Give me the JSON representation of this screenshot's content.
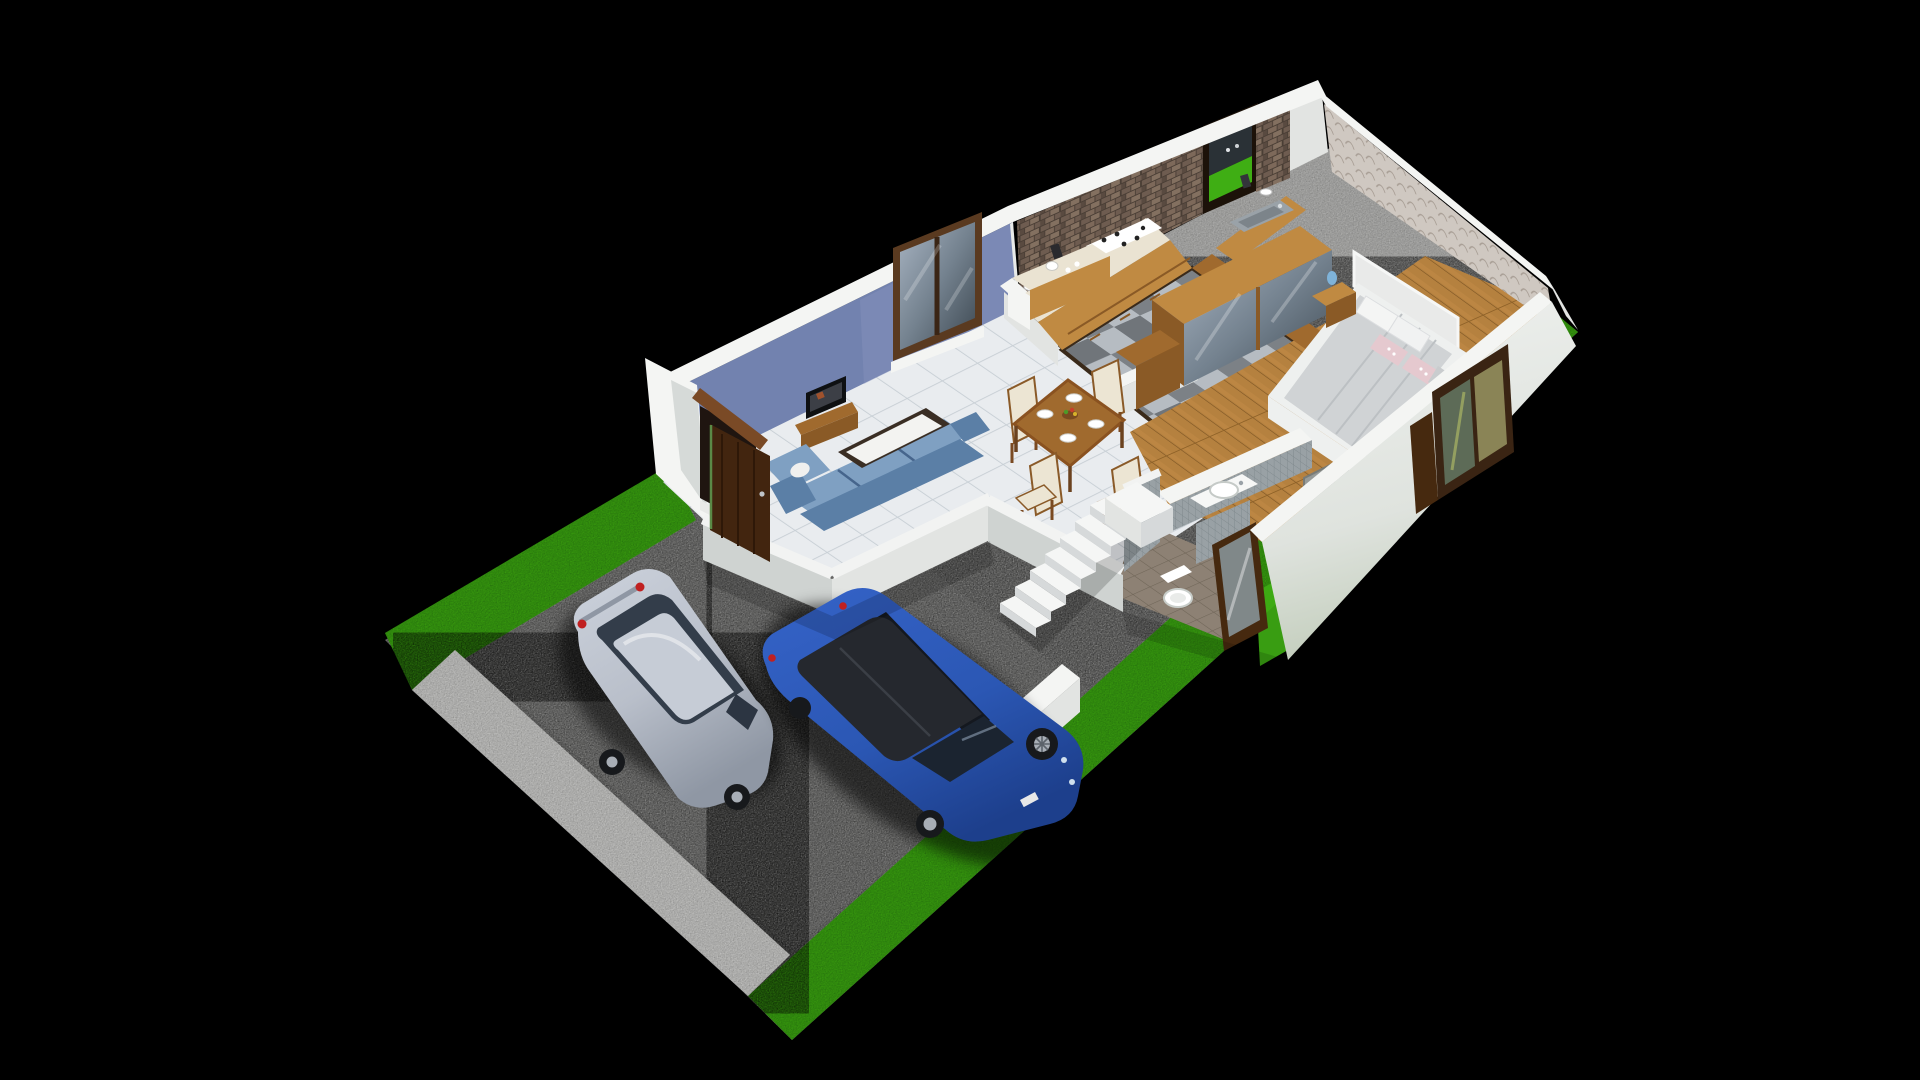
{
  "scene": {
    "kind": "3d-isometric-dollhouse-floorplan-render",
    "background": "#000000",
    "view": "cutaway isometric single-floor house with driveway and lawn"
  },
  "palette": {
    "bg": "#000000",
    "grass": "#3fae14",
    "grass_dark": "#2f8c0e",
    "concrete": "#c6c6c4",
    "concrete_dark": "#b0b0ae",
    "walkway": "#dadad8",
    "wall_white": "#f4f5f3",
    "wall_face": "#e2e4e2",
    "wall_shadow": "#cfd3d1",
    "blue_wall": "#7282af",
    "brick_mortar": "#4a3e35",
    "tile_line": "#c9d0d6",
    "checker_light": "#b6bcc2",
    "checker_dark": "#70757a",
    "floor_border": "#3a2a1a",
    "wood_floor": "#b5813f",
    "wood_cab": "#c08a42",
    "wood_mid": "#a06a2e",
    "wood_dark": "#8a5a26",
    "counter": "#eae3d2",
    "steel": "#9aa2a8",
    "sofa": "#5b7fa6",
    "sofa_light": "#7fa0c2",
    "sofa_dark": "#46658c",
    "cream": "#ece5d3",
    "mattress": "#d0d3d5",
    "bed_white": "#eef0ef",
    "pink": "#e5c9cf",
    "gray_pillow": "#c9ccce",
    "lamp_blue": "#7fb3d9",
    "door_brown": "#42250f",
    "door_lintel": "#7a4a26",
    "door_opening": "#1f1510",
    "glass": "#8d9aa8",
    "glass_dark": "#20262e",
    "bath_floor": "#8d8174",
    "mosaic": "#99a1a5",
    "white_fixture": "#f6f7f6",
    "car_silver": "#b9bfca",
    "car_roof_silver": "#c6ccd6",
    "car_window": "#333d4a",
    "tail_red": "#c02020",
    "suv_blue": "#2b57b4",
    "suv_roof": "#25282e",
    "suv_window": "#14181f",
    "wheel": "#17191c",
    "rim": "#a8aeb6",
    "tread": "#f5f6f5",
    "riser": "#d6d9da",
    "tv_black": "#0e1012"
  },
  "house": {
    "rooms": [
      {
        "name": "living-room"
      },
      {
        "name": "dining-area"
      },
      {
        "name": "kitchen"
      },
      {
        "name": "bedroom"
      },
      {
        "name": "bathroom"
      },
      {
        "name": "hallway"
      },
      {
        "name": "staircase"
      },
      {
        "name": "driveway"
      },
      {
        "name": "lawn"
      }
    ],
    "furniture": [
      "entrance-door",
      "sliding-window",
      "tv",
      "tv-stand",
      "sofa",
      "coffee-table",
      "dining-table",
      "dining-chairs",
      "kitchen-u-counter",
      "gas-hob",
      "kitchen-sink",
      "kitchen-window",
      "wardrobe-sideboard",
      "bed",
      "bedside-tables",
      "table-lamps",
      "bedroom-window",
      "washbasin",
      "toilet",
      "shower-screen",
      "glass-door",
      "compound-wall"
    ],
    "vehicles": [
      {
        "name": "silver-hatchback",
        "color_key": "car_silver"
      },
      {
        "name": "blue-suv",
        "color_key": "suv_blue"
      }
    ],
    "counts": {
      "dining_chairs": 4,
      "dining_plates": 4,
      "stair_steps": 7,
      "bed_pillows": 5,
      "cars": 2
    }
  }
}
